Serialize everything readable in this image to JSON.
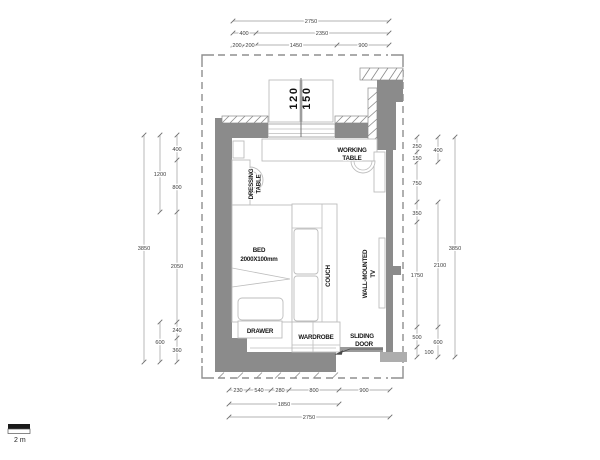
{
  "plan": {
    "furniture": {
      "working_table": [
        "WORKING",
        "TABLE"
      ],
      "dressing_table": [
        "DRESSING",
        "TABLE"
      ],
      "bed": [
        "BED",
        "2000X100mm"
      ],
      "couch": "COUCH",
      "wall_mounted_tv": [
        "WALL-MOUNTED",
        "TV"
      ],
      "drawer": "DRAWER",
      "wardrobe": "WARDROBE",
      "sliding_door": [
        "SLIDING",
        "DOOR"
      ]
    },
    "window_marks": [
      "120",
      "150"
    ],
    "dims": {
      "top": {
        "overall": "2750",
        "row2": [
          "400",
          "2350"
        ],
        "row3": [
          "200",
          "200",
          "1450",
          "900"
        ]
      },
      "bottom": {
        "row1": [
          "230",
          "540",
          "280",
          "800",
          "900"
        ],
        "mid": "1850",
        "overall": "2750"
      },
      "left": {
        "overall": "3850",
        "mid": [
          "1200",
          "600"
        ],
        "inner": [
          "400",
          "800",
          "2050",
          "240",
          "360"
        ]
      },
      "right": {
        "overall": "3850",
        "mid": [
          "400",
          "2100",
          "600"
        ],
        "inner": [
          "250",
          "150",
          "750",
          "350",
          "1750",
          "500",
          "100"
        ]
      }
    },
    "scale_bar_label": "2 m",
    "colors": {
      "wall": "#8b8b8b",
      "wall_light": "#adadad",
      "dashed_boundary": "#8f8f8f",
      "label_text": "#161616",
      "dim_text": "#3e3e3e"
    }
  }
}
